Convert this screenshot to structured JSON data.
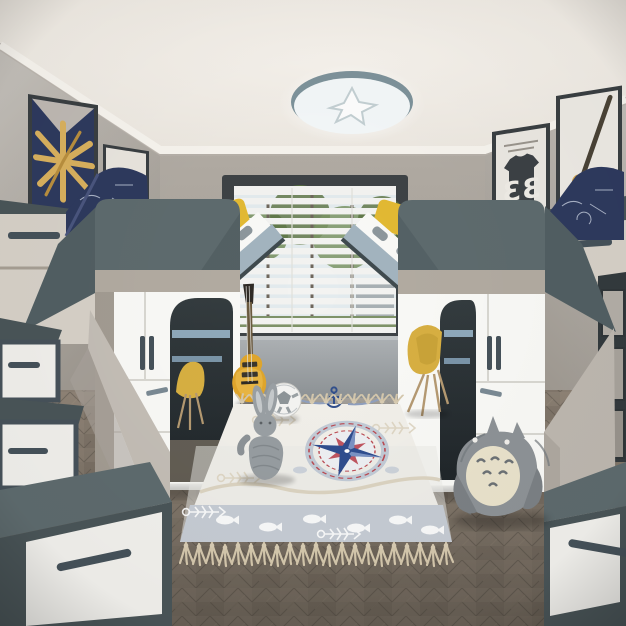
{
  "title": "Children's bedroom with twin loft beds — 3D interior render",
  "scene_type": "photoreal render, one-point perspective, no UI text",
  "palette": {
    "ceiling": "#f3efe9",
    "wall": "#a9a39b",
    "wallLight": "#c7c3bd",
    "molding": "#f7f4ee",
    "slate": "#5e6b6e",
    "slateDeep": "#4a5558",
    "slateDark": "#333a3d",
    "white": "#fafaf7",
    "beige": "#b2aba1",
    "cream": "#d7d1c8",
    "blueGray": "#a3b4bf",
    "steel": "#46525a",
    "yellow": "#e3ba33",
    "guitarYellow": "#e0a62c",
    "navy": "#2e3a5e",
    "red": "#c0392b",
    "frame": "#3a3f42",
    "sky": "#e3ebee",
    "leaf": "#7a9464",
    "leafDark": "#57703f",
    "floor": "#857a6d",
    "floorDark": "#5f584e",
    "rug": "#f2f0ea",
    "rugBand": "#c6ccd4",
    "rugBlue": "#2f4d8f",
    "rugRed": "#c05560",
    "tassel": "#d5c8ad",
    "plush": "#9aa0a4",
    "totoro": "#8e9397",
    "belly": "#eae3cc",
    "bench": "#9da2a5",
    "windowFrame": "#3e4346"
  },
  "posters": {
    "left_star": "starburst of baseball bats on navy",
    "left_letter": "B",
    "right_jersey_number": "33",
    "right_bat": "baseball bat and glove sketch"
  },
  "objects": {
    "ceiling_light": "round cloud-star ceiling lamp",
    "window": "blinds over trees",
    "left_unit": "loft bed with wardrobe, desk nook and storage stairs",
    "right_unit": "loft bed with wardrobe, desk nook and storage stairs",
    "rug": "nautical compass rug with tassels",
    "toys": [
      "yellow electric guitar",
      "soccer ball",
      "knitted bunny plush",
      "totoro plush"
    ],
    "chairs": "yellow shell desk chairs",
    "pillows": [
      "navy print pillow left",
      "navy print pillow right",
      "yellow bunk pillows"
    ]
  }
}
